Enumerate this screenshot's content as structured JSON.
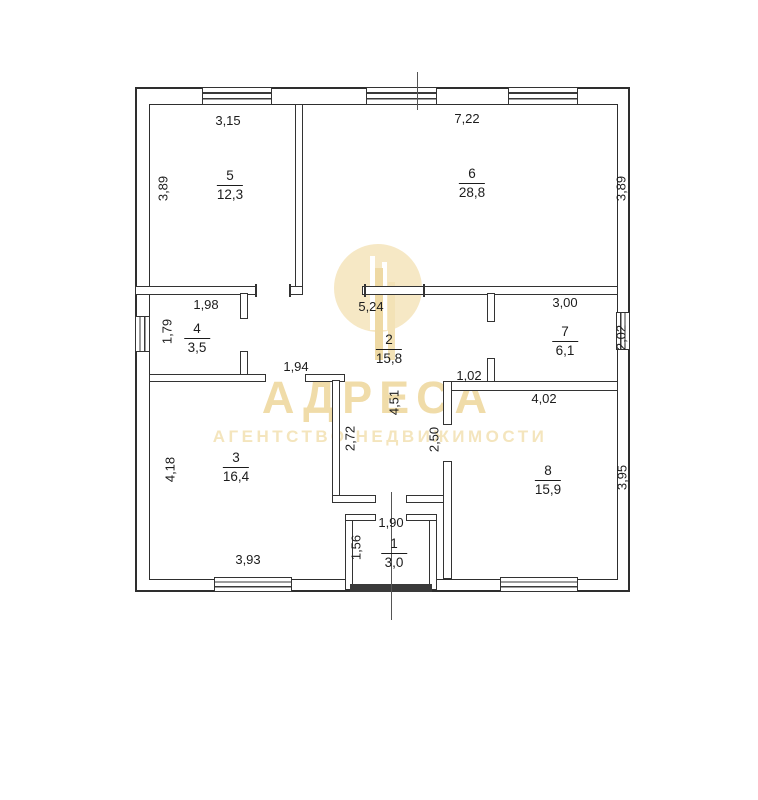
{
  "watermark": {
    "brand": "АДРЕСА",
    "tagline": "АГЕНТСТВО НЕДВИЖИМОСТИ",
    "color": "#f0dca9"
  },
  "plan": {
    "rooms": [
      {
        "number": "5",
        "area": "12,3"
      },
      {
        "number": "6",
        "area": "28,8"
      },
      {
        "number": "4",
        "area": "3,5"
      },
      {
        "number": "2",
        "area": "15,8"
      },
      {
        "number": "7",
        "area": "6,1"
      },
      {
        "number": "3",
        "area": "16,4"
      },
      {
        "number": "8",
        "area": "15,9"
      },
      {
        "number": "1",
        "area": "3,0"
      }
    ],
    "dimensions": [
      {
        "text": "3,15"
      },
      {
        "text": "7,22"
      },
      {
        "text": "3,89"
      },
      {
        "text": "3,89"
      },
      {
        "text": "1,98"
      },
      {
        "text": "5,24"
      },
      {
        "text": "3,00"
      },
      {
        "text": "1,79"
      },
      {
        "text": "2,02"
      },
      {
        "text": "1,94"
      },
      {
        "text": "1,02"
      },
      {
        "text": "4,02"
      },
      {
        "text": "4,51"
      },
      {
        "text": "2,72"
      },
      {
        "text": "2,50"
      },
      {
        "text": "4,18"
      },
      {
        "text": "3,95"
      },
      {
        "text": "1,90"
      },
      {
        "text": "1,56"
      },
      {
        "text": "3,93"
      }
    ]
  }
}
